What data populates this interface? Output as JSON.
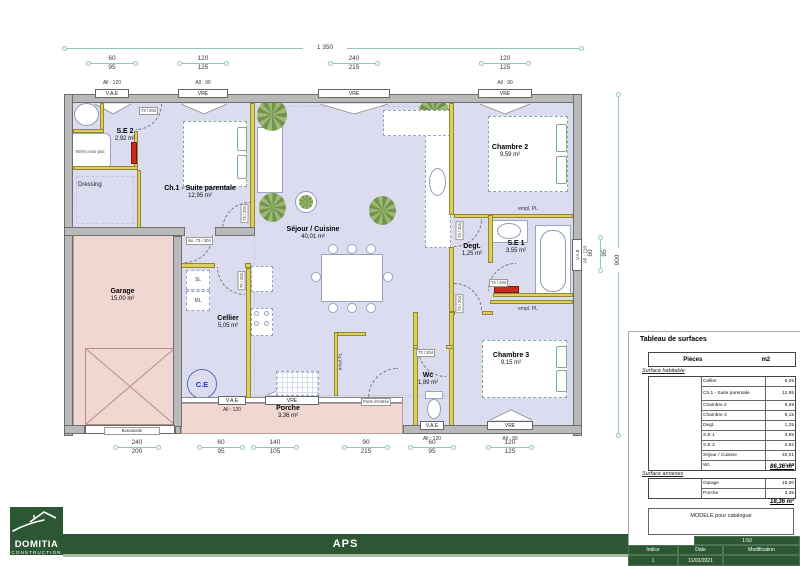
{
  "title_block": {
    "scale": "1:50",
    "col_indice": "Indice",
    "col_date": "Date",
    "col_modification": "Modification",
    "indice_value": "1",
    "date_value": "11/03/2021",
    "note": "MODELE pour catalogue",
    "phase": "APS"
  },
  "logo": {
    "brand": "DOMITIA",
    "sub": "CONSTRUCTION"
  },
  "surface_table": {
    "title": "Tableau de surfaces",
    "header": {
      "pieces": "Pièces",
      "unit": "m2"
    },
    "habitable_label": "Surface habitable",
    "habitable_rows": [
      {
        "name": "Cellier",
        "value": "5,05"
      },
      {
        "name": "Ch.1 - Suite parentale",
        "value": "12,95"
      },
      {
        "name": "Chambre 2",
        "value": "9,59"
      },
      {
        "name": "Chambre 3",
        "value": "9,15"
      },
      {
        "name": "Degt.",
        "value": "1,25"
      },
      {
        "name": "S.E 1",
        "value": "3,55"
      },
      {
        "name": "S.E 2",
        "value": "2,92"
      },
      {
        "name": "Séjour / Cuisine",
        "value": "40,01"
      },
      {
        "name": "Wc",
        "value": "1,89"
      }
    ],
    "habitable_total": "86,36 m²",
    "annexes_label": "Surface annexes",
    "annexes_rows": [
      {
        "name": "Garage",
        "value": "15,00"
      },
      {
        "name": "Porche",
        "value": "3,36"
      }
    ],
    "annexes_total": "18,36 m²"
  },
  "rooms": {
    "se2": {
      "name": "S.E 2",
      "area": "2,92 m²"
    },
    "ch1": {
      "name": "Ch.1 - Suite parentale",
      "area": "12,95 m²"
    },
    "dressing": {
      "name": "Dressing"
    },
    "sejour": {
      "name": "Séjour / Cuisine",
      "area": "40,01 m²"
    },
    "cellier": {
      "name": "Cellier",
      "area": "5,05 m²"
    },
    "garage": {
      "name": "Garage",
      "area": "15,00 m²"
    },
    "porche": {
      "name": "Porche",
      "area": "3,36 m²"
    },
    "chambre2": {
      "name": "Chambre 2",
      "area": "9,59 m²"
    },
    "degt": {
      "name": "Degt.",
      "area": "1,25 m²"
    },
    "se1": {
      "name": "S.E 1",
      "area": "3,55 m²"
    },
    "chambre3": {
      "name": "Chambre 3",
      "area": "9,15 m²"
    },
    "wc": {
      "name": "Wc",
      "area": "1,89 m²"
    }
  },
  "dims": {
    "top_total": "1 350",
    "top_segments": [
      {
        "over": "60",
        "under": "95"
      },
      {
        "over": "120",
        "under": "125"
      },
      {
        "over": "240",
        "under": "215"
      },
      {
        "over": "120",
        "under": "125"
      }
    ],
    "bottom_segments": [
      {
        "over": "240",
        "under": "200"
      },
      {
        "over": "60",
        "under": "95"
      },
      {
        "over": "140",
        "under": "105"
      },
      {
        "over": "90",
        "under": "215"
      },
      {
        "over": "60",
        "under": "95"
      },
      {
        "over": "120",
        "under": "125"
      }
    ],
    "right_total": "900",
    "right_segment": {
      "over": "60",
      "under": "95"
    }
  },
  "openings": {
    "top": [
      {
        "lintel": "All : 120",
        "label": "V.A.E"
      },
      {
        "lintel": "All : 90",
        "label": "VRE"
      },
      {
        "lintel": "",
        "label": "VRE"
      },
      {
        "lintel": "All : 90",
        "label": "VRE"
      }
    ],
    "bottom": [
      {
        "label": "V.A.E",
        "lintel": "All : 120"
      },
      {
        "label": "VRE",
        "lintel": "All : 90"
      }
    ],
    "right": {
      "label": "V.A.E",
      "lintel": "All : 120"
    },
    "porch": [
      {
        "label": "V.A.E",
        "lintel": "All : 120"
      },
      {
        "label": "VRE",
        "lintel": ""
      }
    ],
    "entry_door": "Porte d'entrée",
    "garage_door": "Basculante"
  },
  "tags": {
    "door_std": "73 / 204",
    "door_iso": "iso. 73 / 204",
    "door_70": "70 / 204",
    "empl_pl": "empl. PL",
    "empl_pl_tight": "empl.PL",
    "sl": "SL",
    "ml": "ML",
    "ce": "C.E",
    "shower": "90/90 extra-plat"
  },
  "colors": {
    "green": "#2d5733",
    "dim_line": "#93c9ae",
    "floor": "#dcdcf0",
    "annex_floor": "#f1d7d2",
    "partition": "#ddcf5e",
    "radiator": "#cc2a1e",
    "wall": "#b9b9b9"
  }
}
